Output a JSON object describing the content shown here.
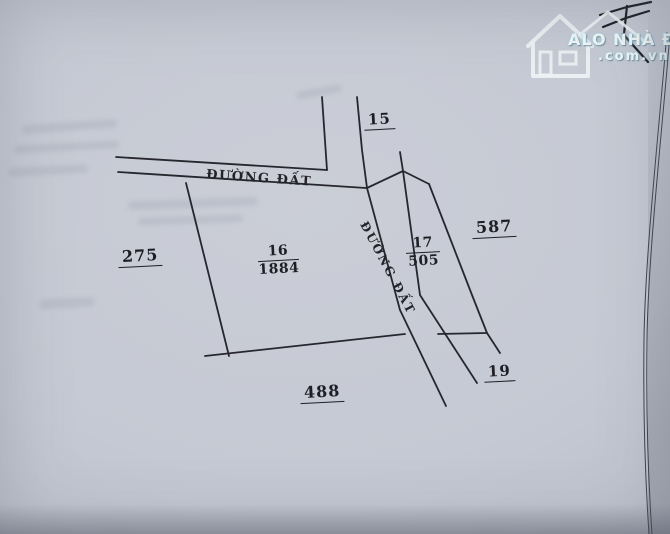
{
  "watermark": {
    "brand": "ALO NHÀ ĐẤT",
    "domain": ".com.vn"
  },
  "diagram": {
    "road_horizontal": "ĐƯỜNG ĐẤT",
    "road_vertical": "ĐƯỜNG ĐẤT",
    "parcels": {
      "p15": {
        "number": "15"
      },
      "p16": {
        "number": "16",
        "area": "1884"
      },
      "p17": {
        "number": "17",
        "area": "505"
      },
      "p19": {
        "number": "19"
      },
      "p275": {
        "number": "275"
      },
      "p587": {
        "number": "587"
      },
      "p488": {
        "number": "488"
      }
    }
  },
  "colors": {
    "paper": "#c5c9d3",
    "ink": "#26262e",
    "watermark_text": "#f2f6f7",
    "watermark_glow": "#8fd0e0"
  }
}
